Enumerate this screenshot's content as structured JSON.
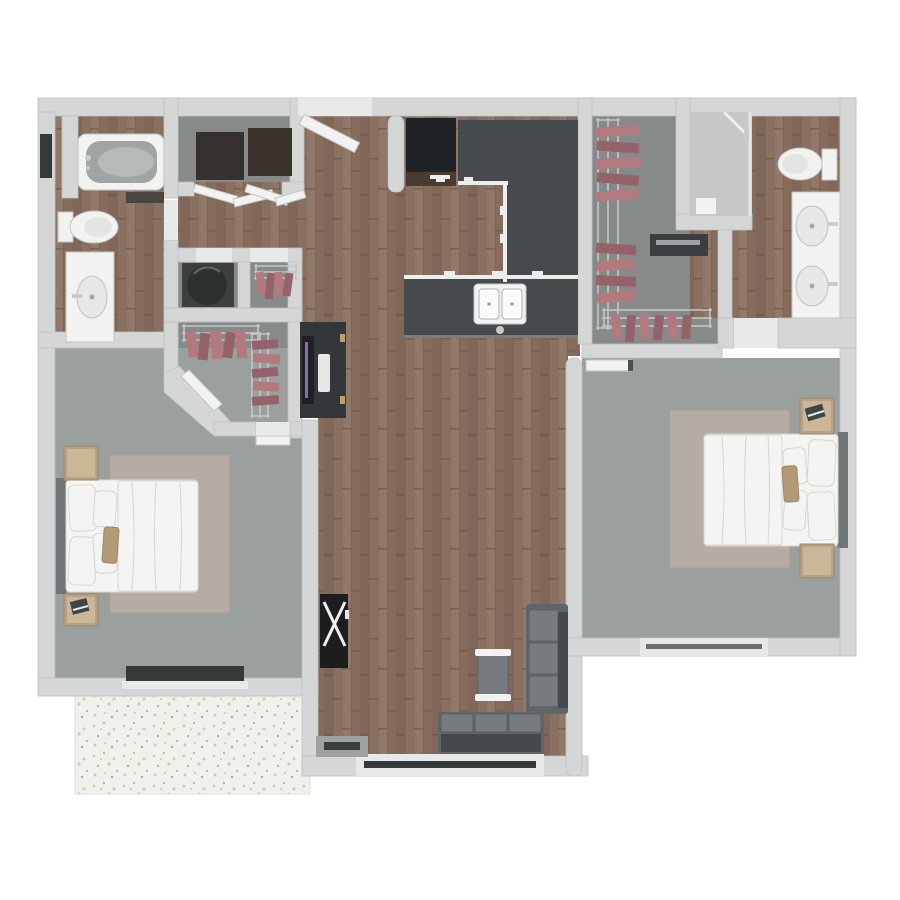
{
  "scene": {
    "description": "Top-down 3D rendered floor plan of a two-bedroom, two-bathroom apartment with kitchen, living-dining room, walk-in closets and patio",
    "view": "top-down-3d-floorplan",
    "background": "#ffffff"
  },
  "palette": {
    "wall": "#d4d7d6",
    "wallEdge": "#bdc1c0",
    "threshold": "#e8eae8",
    "wood": "#8a7061",
    "woodDark": "#785f51",
    "woodLight": "#977d6e",
    "woodJoint": "#64503f",
    "carpet": "#9aa09d",
    "closetFloor": "#868b8a",
    "patio": "#eff1ea",
    "patioEdge": "#dde0d5",
    "patioFleck1": "#c9cdbc",
    "patioFleck2": "#b3a896",
    "counter": "#474a4c",
    "counterEdge": "#eceded",
    "fixture": "#f2f3f1",
    "fixtureEdge": "#c2c6c5",
    "tubInner": "#a0a4a5",
    "glass": "#36393a",
    "windowFrame": "#e7e9e8",
    "rug": "#b5ada4",
    "rugEdge": "#a79f96",
    "bedding": "#f4f4f2",
    "beddingEdge": "#d6d6d2",
    "nightstand": "#b8a287",
    "nightstandEdge": "#9c8669",
    "nightstandTop": "#cbb697",
    "accentPillow": "#b29a77",
    "accentPillowEdge": "#97805f",
    "sofa": "#60656a",
    "sofaLight": "#767b80",
    "sofaSeam": "#5a5f64",
    "sofaDark": "#45494d",
    "rack": "#c3c7c8",
    "clothes": "#b2797e",
    "clothesDark": "#96626a",
    "darkAppliance": "#2d3031",
    "cabinetWood": "#4a3a30",
    "desk": "#33373a",
    "screen": "#8a6aa8",
    "black": "#1b1d1f",
    "chrome": "#c8cbcb"
  },
  "rooms": [
    {
      "id": "bathroom-1",
      "features": [
        "bathtub",
        "toilet",
        "vanity-sink",
        "open-door",
        "wall-window"
      ]
    },
    {
      "id": "laundry-closet",
      "features": [
        "washer",
        "dryer",
        "open-bifold-doors"
      ]
    },
    {
      "id": "utility-closet",
      "features": [
        "water-heater"
      ]
    },
    {
      "id": "linen-closet",
      "features": [
        "wire-shelf",
        "hanging-clothes"
      ]
    },
    {
      "id": "walk-in-closet-1",
      "features": [
        "wire-shelves",
        "hanging-clothes",
        "angled-door"
      ]
    },
    {
      "id": "hallway",
      "features": []
    },
    {
      "id": "entry",
      "features": [
        "open-entry-door"
      ]
    },
    {
      "id": "kitchen",
      "features": [
        "refrigerator",
        "u-shaped-counter",
        "island",
        "double-basin-sink",
        "faucet"
      ]
    },
    {
      "id": "living-dining-room",
      "features": [
        "desk-with-monitor-and-keyboard",
        "x-base-console-table",
        "sofa",
        "chaise-sofa",
        "tufted-ottoman",
        "media-console",
        "sliding-glass-window"
      ]
    },
    {
      "id": "bedroom-1",
      "features": [
        "bed-white-bedding",
        "pillows",
        "accent-pillow",
        "area-rug",
        "two-nightstands",
        "book",
        "window"
      ]
    },
    {
      "id": "walk-in-closet-2",
      "features": [
        "wire-shelves",
        "hanging-clothes",
        "low-dresser-bench"
      ]
    },
    {
      "id": "bathroom-2",
      "features": [
        "glass-shower",
        "toilet",
        "double-sink-vanity",
        "faucets"
      ]
    },
    {
      "id": "bedroom-2",
      "features": [
        "bed-white-bedding",
        "pillows",
        "accent-pillow",
        "area-rug",
        "two-nightstands",
        "book",
        "open-door",
        "window"
      ]
    },
    {
      "id": "patio",
      "features": [
        "speckled-concrete-floor"
      ]
    }
  ]
}
